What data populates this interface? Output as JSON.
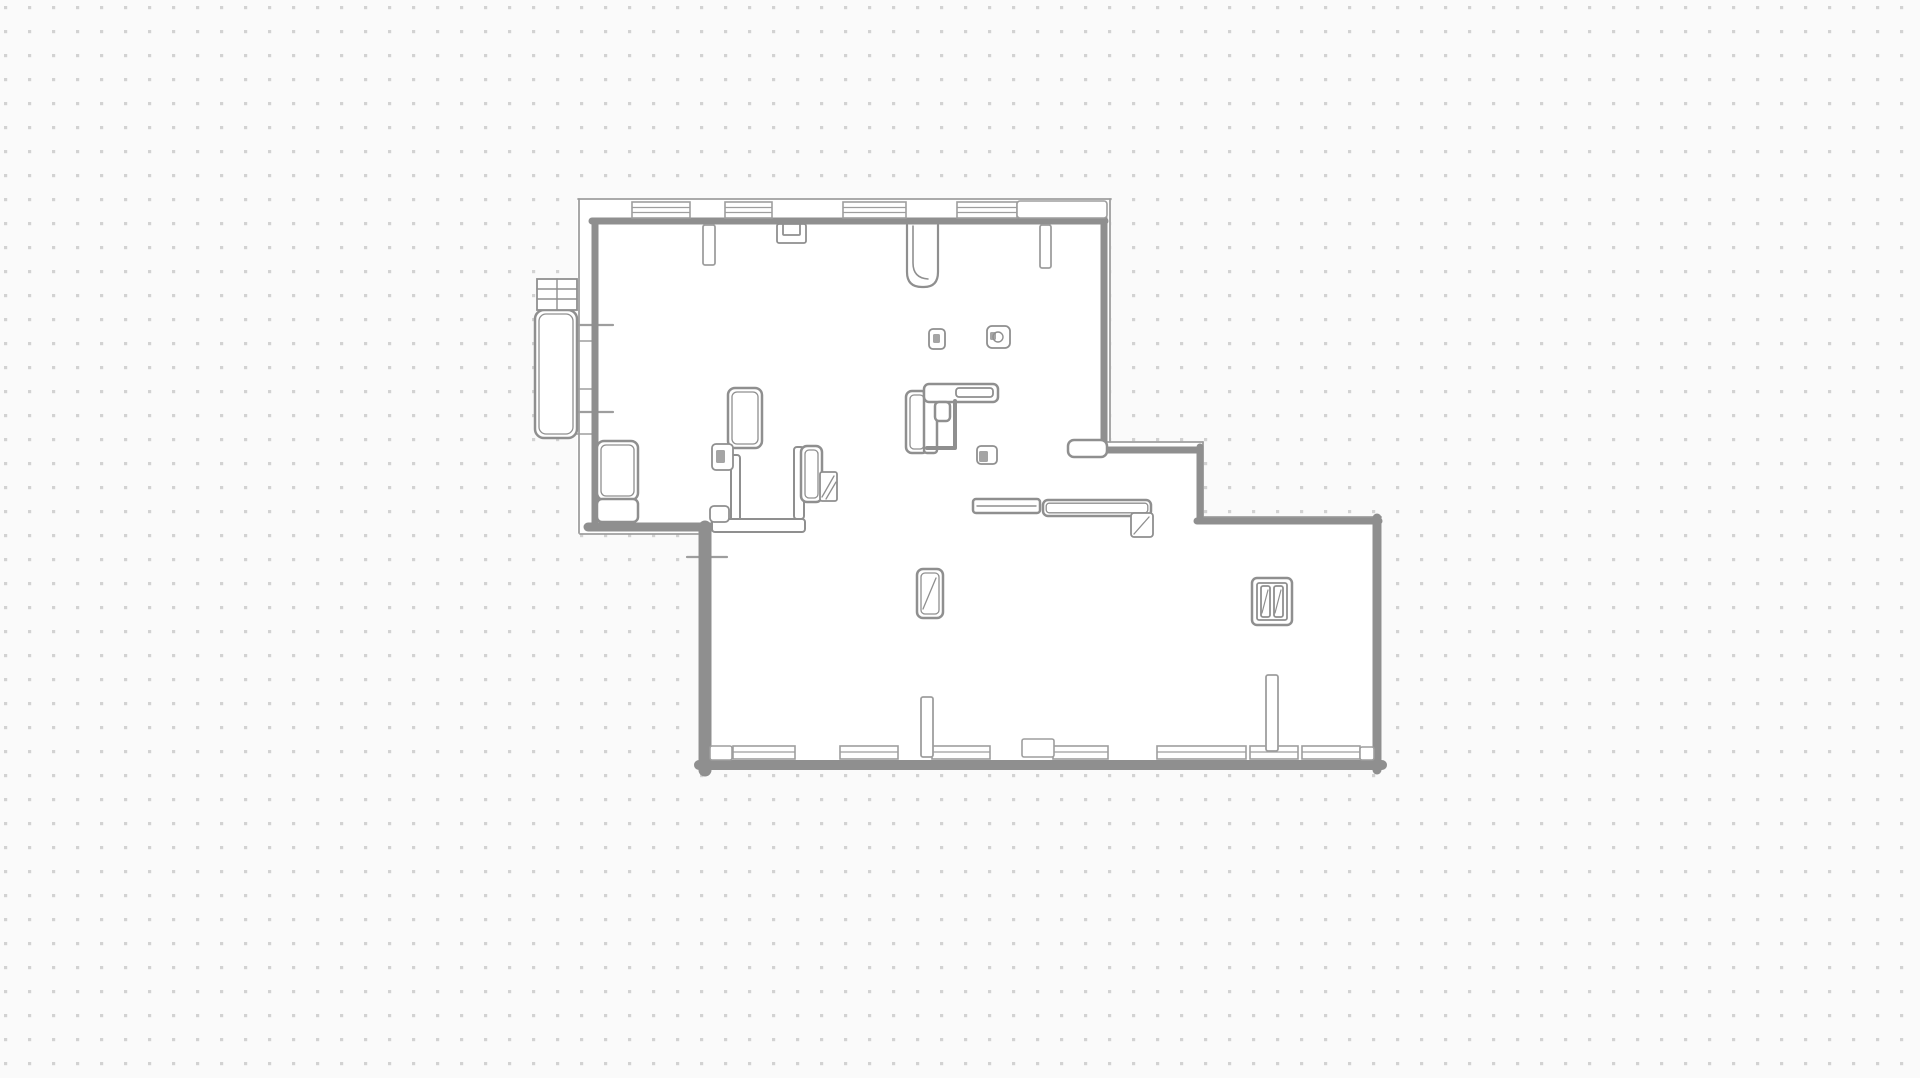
{
  "app": {
    "title": "Floor Plan"
  },
  "canvas": {
    "width": 1920,
    "height": 1078,
    "bg": "#fafafa",
    "dot": "#d2d2d2",
    "dot_gap": 24,
    "dot_size": 3.2,
    "floor": "#ffffff",
    "ink": "#8f8f8f",
    "ink_light": "#9e9e9e",
    "dark": "#a5a5a5"
  },
  "floorplan": {
    "footprint": "577,198 1111,198 1111,443 1199,443 1199,517 1382,517 1382,768 698,768 698,533 577,533",
    "walls_thick": [
      {
        "n": "wall-upper-left",
        "d": "M 595,528 L 595,224",
        "w": 7
      },
      {
        "n": "wall-upper-top",
        "d": "M 592,221 L 1105,221",
        "w": 7
      },
      {
        "n": "wall-upper-right",
        "d": "M 1104,218 L 1104,451",
        "w": 7
      },
      {
        "n": "wall-upper-bottom",
        "d": "M 588,527 L 714,527",
        "w": 9
      },
      {
        "n": "wall-step-top",
        "d": "M 1101,450 L 1200,450",
        "w": 7
      },
      {
        "n": "wall-step-right",
        "d": "M 1200,447 L 1200,521",
        "w": 7
      },
      {
        "n": "wall-lower-top",
        "d": "M 1197,521 L 1379,521",
        "w": 7
      },
      {
        "n": "wall-lower-right",
        "d": "M 1377,518 L 1377,770",
        "w": 9
      },
      {
        "n": "wall-lower-bottom",
        "d": "M 1382,765 L 699,765",
        "w": 10
      },
      {
        "n": "wall-lower-left",
        "d": "M 705,770 L 705,527",
        "w": 13
      }
    ],
    "walls_thin": [
      {
        "n": "outline-left",
        "d": "M 579,199 L 579,533",
        "w": 1.8
      },
      {
        "n": "outline-top",
        "d": "M 578,199 L 1111,199",
        "w": 1.8
      },
      {
        "n": "outline-right-upper",
        "d": "M 1110,199 L 1110,442",
        "w": 1.8
      },
      {
        "n": "outline-bottom-upper",
        "d": "M 580,534 L 698,534",
        "w": 1.8
      },
      {
        "n": "outline-step-top",
        "d": "M 1104,442 L 1203,442",
        "w": 1.8
      },
      {
        "n": "outline-step-right",
        "d": "M 1203,442 L 1203,517",
        "w": 1.8
      },
      {
        "n": "outline-lower-top",
        "d": "M 1203,517 L 1381,517",
        "w": 1.8
      },
      {
        "n": "tick-balcony-upper",
        "d": "M 564,325 L 613,325",
        "w": 2.2
      },
      {
        "n": "tick-balcony-lower",
        "d": "M 564,412 L 613,412",
        "w": 2.2
      },
      {
        "n": "tick-left-a",
        "d": "M 577,341 L 595,341",
        "w": 1.5
      },
      {
        "n": "tick-left-b",
        "d": "M 577,389 L 595,389",
        "w": 1.5
      },
      {
        "n": "tick-left-c",
        "d": "M 577,434 L 595,434",
        "w": 1.5
      },
      {
        "n": "tick-lower-left",
        "d": "M 687,557 L 727,557",
        "w": 2.2
      }
    ],
    "top_windows": [
      {
        "x": 632,
        "y": 202,
        "w": 58,
        "h": 16
      },
      {
        "x": 725,
        "y": 202,
        "w": 47,
        "h": 16
      },
      {
        "x": 843,
        "y": 202,
        "w": 63,
        "h": 16
      },
      {
        "x": 957,
        "y": 202,
        "w": 60,
        "h": 16
      }
    ],
    "blank_band": {
      "x": 1017,
      "y": 201,
      "w": 90,
      "h": 17
    },
    "bottom_windows": {
      "y": 746,
      "h": 13,
      "items": [
        {
          "x": 733,
          "w": 62
        },
        {
          "x": 840,
          "w": 58
        },
        {
          "x": 932,
          "w": 58
        },
        {
          "x": 1053,
          "w": 55
        },
        {
          "x": 1157,
          "w": 89
        },
        {
          "x": 1250,
          "w": 48
        },
        {
          "x": 1302,
          "w": 58
        }
      ]
    },
    "corner_blocks": [
      {
        "x": 710,
        "y": 746,
        "w": 22,
        "h": 14
      },
      {
        "x": 1360,
        "y": 747,
        "w": 14,
        "h": 13
      },
      {
        "x": 1022,
        "y": 739,
        "w": 32,
        "h": 18
      }
    ],
    "wall_stubs": [
      {
        "x": 703,
        "y": 225,
        "w": 12,
        "h": 40
      },
      {
        "x": 1040,
        "y": 225,
        "w": 11,
        "h": 43
      },
      {
        "x": 921,
        "y": 697,
        "w": 12,
        "h": 60
      },
      {
        "x": 1266,
        "y": 675,
        "w": 12,
        "h": 76
      }
    ],
    "partitions": [
      {
        "x": 731,
        "y": 455,
        "w": 9,
        "h": 70,
        "rx": 3
      },
      {
        "x": 712,
        "y": 519,
        "w": 93,
        "h": 13,
        "rx": 3
      },
      {
        "x": 794,
        "y": 447,
        "w": 10,
        "h": 72,
        "rx": 3
      }
    ],
    "furniture": [
      {
        "n": "balcony",
        "x": 535,
        "y": 310,
        "w": 42,
        "h": 128,
        "rx": 9,
        "inner": true
      },
      {
        "n": "cabinet-a",
        "x": 597,
        "y": 441,
        "w": 41,
        "h": 59,
        "rx": 7,
        "inner": true
      },
      {
        "n": "cabinet-b",
        "x": 597,
        "y": 499,
        "w": 41,
        "h": 23,
        "rx": 5,
        "inner": false
      },
      {
        "n": "door-leaf-a",
        "x": 728,
        "y": 388,
        "w": 34,
        "h": 60,
        "rx": 7,
        "inner": true
      },
      {
        "n": "door-leaf-b",
        "x": 801,
        "y": 446,
        "w": 21,
        "h": 56,
        "rx": 6,
        "inner": true
      },
      {
        "n": "door-leaf-c",
        "x": 1068,
        "y": 440,
        "w": 39,
        "h": 17,
        "rx": 6,
        "inner": false
      },
      {
        "n": "kitchen-unit",
        "x": 906,
        "y": 391,
        "w": 22,
        "h": 62,
        "rx": 6,
        "inner": true
      },
      {
        "n": "kitchen-tall",
        "x": 924,
        "y": 389,
        "w": 13,
        "h": 64,
        "rx": 3,
        "inner": false
      },
      {
        "n": "kitchen-counter",
        "x": 924,
        "y": 384,
        "w": 74,
        "h": 18,
        "rx": 5,
        "inner": false
      },
      {
        "n": "chair",
        "x": 935,
        "y": 402,
        "w": 15,
        "h": 19,
        "rx": 4,
        "inner": false
      },
      {
        "n": "counter-a",
        "x": 973,
        "y": 499,
        "w": 67,
        "h": 14,
        "rx": 3,
        "inner": false
      },
      {
        "n": "counter-b",
        "x": 1043,
        "y": 500,
        "w": 108,
        "h": 16,
        "rx": 5,
        "inner": true
      },
      {
        "n": "radiator",
        "x": 917,
        "y": 569,
        "w": 26,
        "h": 49,
        "rx": 6,
        "inner": true
      },
      {
        "n": "column-unit",
        "x": 1252,
        "y": 578,
        "w": 40,
        "h": 47,
        "rx": 5,
        "inner": false
      }
    ],
    "small_rects": [
      {
        "n": "pier",
        "x": 712,
        "y": 444,
        "w": 21,
        "h": 26,
        "rx": 4
      },
      {
        "n": "pier-box",
        "x": 710,
        "y": 506,
        "w": 19,
        "h": 16,
        "rx": 4
      },
      {
        "n": "hatch-box",
        "x": 820,
        "y": 472,
        "w": 17,
        "h": 29,
        "rx": 2
      },
      {
        "n": "counter-return",
        "x": 1131,
        "y": 513,
        "w": 22,
        "h": 24,
        "rx": 3
      },
      {
        "n": "outlet-a",
        "x": 929,
        "y": 329,
        "w": 16,
        "h": 20,
        "rx": 4
      },
      {
        "n": "outlet-b",
        "x": 987,
        "y": 326,
        "w": 23,
        "h": 22,
        "rx": 5
      },
      {
        "n": "kitchen-pad",
        "x": 977,
        "y": 446,
        "w": 20,
        "h": 18,
        "rx": 4
      },
      {
        "n": "counter-innerbar",
        "x": 956,
        "y": 388,
        "w": 37,
        "h": 9,
        "rx": 3
      },
      {
        "n": "column-inner",
        "x": 1257,
        "y": 583,
        "w": 30,
        "h": 37,
        "rx": 2
      },
      {
        "n": "column-bar-a",
        "x": 1261,
        "y": 586,
        "w": 9,
        "h": 31,
        "rx": 2
      },
      {
        "n": "column-bar-b",
        "x": 1274,
        "y": 586,
        "w": 9,
        "h": 31,
        "rx": 2
      },
      {
        "n": "balcony-grid",
        "x": 537,
        "y": 279,
        "w": 40,
        "h": 31,
        "rx": 0
      },
      {
        "n": "niche-outer",
        "x": 777,
        "y": 224,
        "w": 29,
        "h": 19,
        "rx": 2
      },
      {
        "n": "niche-inner",
        "x": 783,
        "y": 224,
        "w": 17,
        "h": 11,
        "rx": 1
      }
    ],
    "detail_lines": [
      {
        "n": "balcony-grid-v",
        "d": "M 557,279 L 557,310",
        "w": 1.4
      },
      {
        "n": "balcony-grid-h1",
        "d": "M 537,289 L 577,289",
        "w": 1.4
      },
      {
        "n": "balcony-grid-h2",
        "d": "M 537,299 L 577,299",
        "w": 1.4
      },
      {
        "n": "kitchen-hook",
        "d": "M 955,401 L 955,448 L 927,448",
        "w": 4
      },
      {
        "n": "hatch-diag-1",
        "d": "M 822,497 L 834,476",
        "w": 1.3
      },
      {
        "n": "hatch-diag-2",
        "d": "M 826,499 L 836,482",
        "w": 1.3
      },
      {
        "n": "return-diag",
        "d": "M 1134,534 L 1149,517",
        "w": 1.3
      },
      {
        "n": "radiator-diag",
        "d": "M 923,609 L 936,578",
        "w": 1.3
      },
      {
        "n": "counter-a-line",
        "d": "M 977,506 L 1036,506",
        "w": 1.4
      },
      {
        "n": "column-bar-diag-1",
        "d": "M 1262,613 L 1268,590",
        "w": 1.2
      },
      {
        "n": "column-bar-diag-2",
        "d": "M 1275,613 L 1281,590",
        "w": 1.2
      }
    ],
    "dark_fills": [
      {
        "x": 933,
        "y": 334,
        "w": 7,
        "h": 9
      },
      {
        "x": 990,
        "y": 332,
        "w": 6,
        "h": 8
      },
      {
        "x": 979,
        "y": 451,
        "w": 9,
        "h": 11
      },
      {
        "x": 716,
        "y": 450,
        "w": 9,
        "h": 13
      }
    ],
    "circles": [
      {
        "cx": 998,
        "cy": 337,
        "r": 5
      }
    ],
    "special_paths": [
      {
        "n": "door-pier-u",
        "d": "M 907,225 L 907,272 Q 907,287 922,287 L 924,287 Q 938,287 938,272 L 938,225",
        "w": 2.2,
        "fill": "#ffffff"
      },
      {
        "n": "door-pier-inner",
        "d": "M 913,226 L 913,263 Q 913,278 928,279",
        "w": 1.6,
        "fill": "none"
      }
    ]
  }
}
